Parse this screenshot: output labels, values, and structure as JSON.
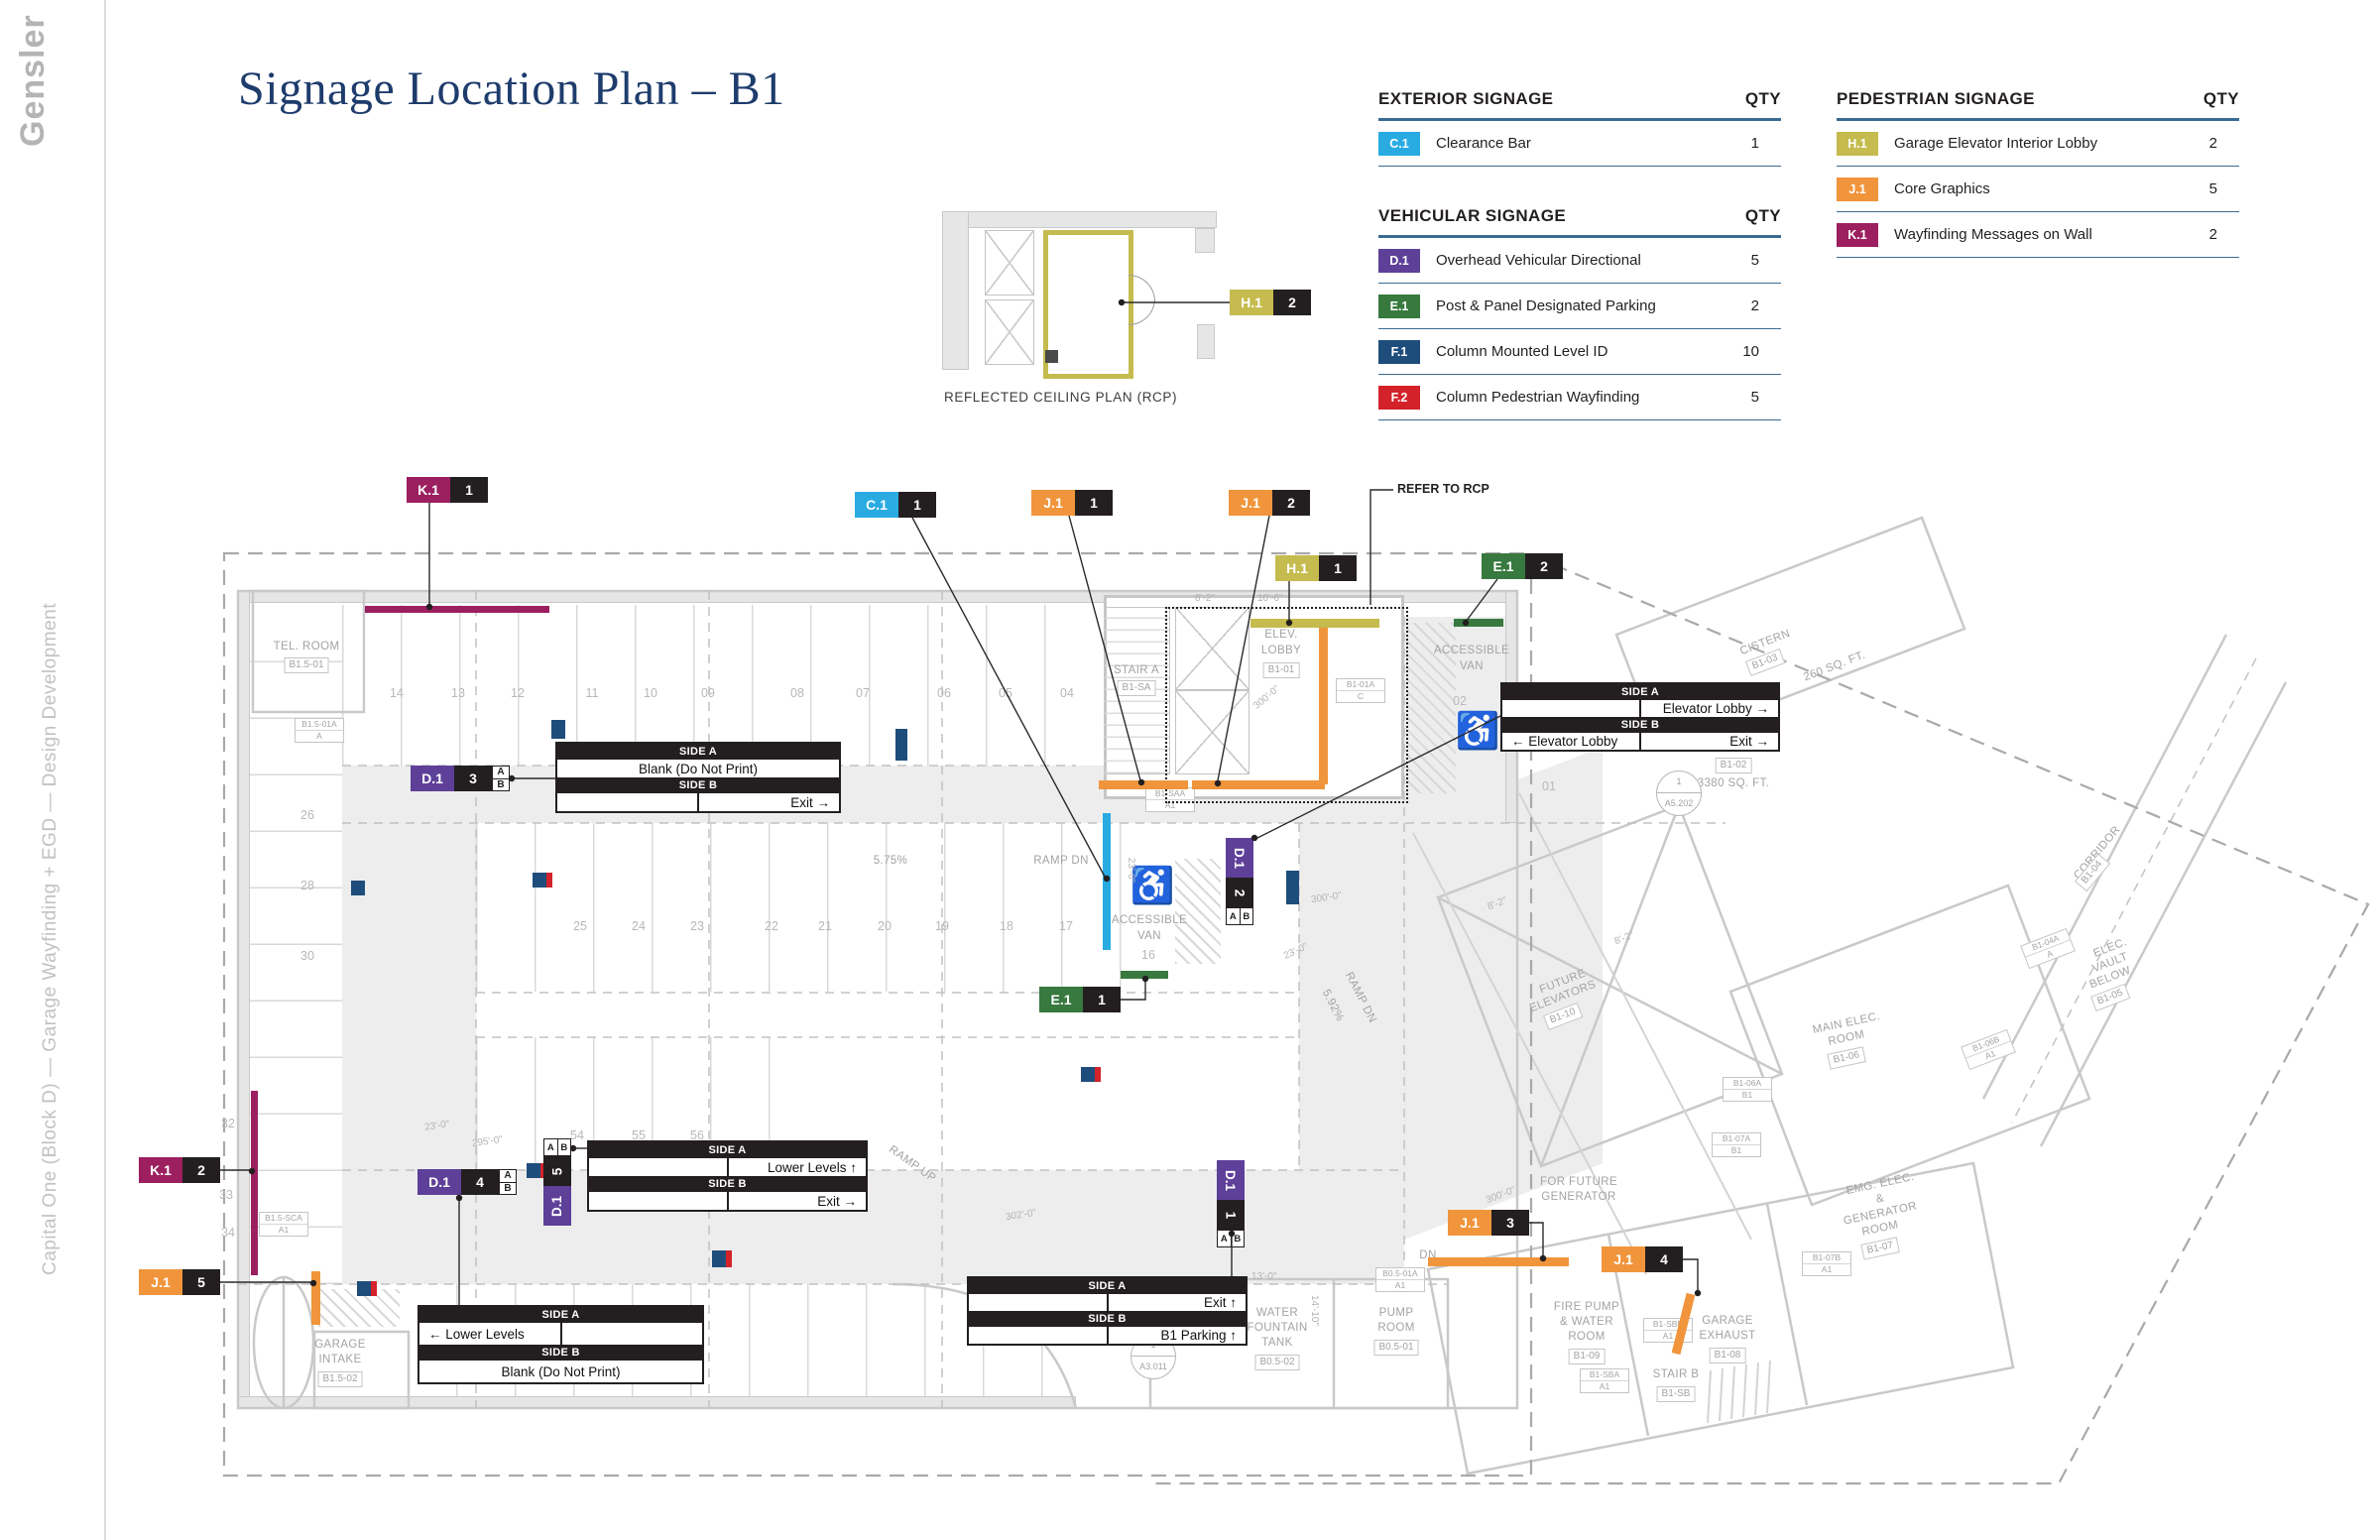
{
  "brand": {
    "logo": "Gensler",
    "project": "Capital One (Block D) — Garage Wayfinding + EGD — Design Development"
  },
  "title": "Signage Location Plan – B1",
  "legend": {
    "sections": [
      {
        "title": "EXTERIOR SIGNAGE",
        "qty_label": "QTY",
        "rows": [
          {
            "code": "C.1",
            "color": "#29abe2",
            "label": "Clearance Bar",
            "qty": "1"
          }
        ]
      },
      {
        "title": "VEHICULAR SIGNAGE",
        "qty_label": "QTY",
        "rows": [
          {
            "code": "D.1",
            "color": "#5e4099",
            "label": "Overhead Vehicular Directional",
            "qty": "5"
          },
          {
            "code": "E.1",
            "color": "#37793f",
            "label": "Post & Panel Designated Parking",
            "qty": "2"
          },
          {
            "code": "F.1",
            "color": "#1f4d7b",
            "label": "Column Mounted Level ID",
            "qty": "10"
          },
          {
            "code": "F.2",
            "color": "#d3222a",
            "label": "Column Pedestrian Wayfinding",
            "qty": "5"
          }
        ]
      },
      {
        "title": "PEDESTRIAN SIGNAGE",
        "qty_label": "QTY",
        "rows": [
          {
            "code": "H.1",
            "color": "#c5bb4e",
            "label": "Garage Elevator Interior Lobby",
            "qty": "2"
          },
          {
            "code": "J.1",
            "color": "#f0953c",
            "label": "Core Graphics",
            "qty": "5"
          },
          {
            "code": "K.1",
            "color": "#9c1f60",
            "label": "Wayfinding Messages on Wall",
            "qty": "2"
          }
        ]
      }
    ]
  },
  "rcp": {
    "caption": "REFLECTED CEILING PLAN (RCP)",
    "note": "REFER TO RCP"
  },
  "ab": {
    "a": "A",
    "b": "B"
  },
  "tags": [
    {
      "code": "K.1",
      "num": "1"
    },
    {
      "code": "C.1",
      "num": "1"
    },
    {
      "code": "J.1",
      "num": "1"
    },
    {
      "code": "J.1",
      "num": "2"
    },
    {
      "code": "H.1",
      "num": "1"
    },
    {
      "code": "E.1",
      "num": "2"
    },
    {
      "code": "H.1",
      "num": "2"
    },
    {
      "code": "D.1",
      "num": "3"
    },
    {
      "code": "D.1",
      "num": "2"
    },
    {
      "code": "E.1",
      "num": "1"
    },
    {
      "code": "D.1",
      "num": "4"
    },
    {
      "code": "D.1",
      "num": "5"
    },
    {
      "code": "D.1",
      "num": "1"
    },
    {
      "code": "K.1",
      "num": "2"
    },
    {
      "code": "J.1",
      "num": "5"
    },
    {
      "code": "J.1",
      "num": "3"
    },
    {
      "code": "J.1",
      "num": "4"
    }
  ],
  "panel_headers": {
    "side_a": "SIDE A",
    "side_b": "SIDE B"
  },
  "panels": [
    {
      "a_left": "",
      "a_right": "Elevator Lobby  →",
      "b_left": "←  Elevator Lobby",
      "b_right": "Exit  →"
    },
    {
      "a_full": "Blank (Do Not Print)",
      "b_left": "",
      "b_right": "Exit  →"
    },
    {
      "a_left": "←  Lower Levels",
      "a_right": "",
      "b_full": "Blank (Do Not Print)"
    },
    {
      "a_left": "",
      "a_right": "Lower Levels  ↑",
      "b_left": "",
      "b_right": "Exit  →"
    },
    {
      "a_left": "",
      "a_right": "Exit  ↑",
      "b_left": "",
      "b_right": "B1 Parking  ↑"
    }
  ],
  "plan": {
    "stalls_top": [
      "14",
      "13",
      "12",
      "11",
      "10",
      "09",
      "08",
      "07",
      "06",
      "05",
      "04"
    ],
    "stalls_mid": [
      "25",
      "24",
      "23",
      "22",
      "21",
      "20",
      "19",
      "18",
      "17"
    ],
    "stalls_mid2": [
      "54",
      "55",
      "56"
    ],
    "stalls_left": [
      "26",
      "28",
      "30",
      "32",
      "33",
      "34"
    ],
    "stall_15": "15",
    "stall_16": "16",
    "stall_01": "01",
    "stall_02": "02",
    "labels": {
      "tel_room": "TEL. ROOM",
      "tel_id": "B1.5-01",
      "stair_a": "STAIR A",
      "stair_a_id": "B1-SA",
      "elev": "ELEV.",
      "lobby": "LOBBY",
      "lobby_id": "B1-01",
      "accessible": "ACCESSIBLE",
      "van": "VAN",
      "wheelchair": "♿",
      "ramp_dn": "RAMP DN",
      "ramp_up": "RAMP UP",
      "slope1": "5.75%",
      "slope2": "5.92%",
      "cistern": "CISTERN",
      "cistern_id": "B1-03",
      "cistern_sf": "260 SQ. FT.",
      "vault_id": "B1-02",
      "vault_sf": "3380 SQ. FT.",
      "corridor": "CORRIDOR",
      "corridor_id": "B1-04",
      "elec": "ELEC.",
      "vault": "VAULT",
      "below": "BELOW",
      "elec_vault_id": "B1-05",
      "future": "FUTURE",
      "elevators": "ELEVATORS",
      "future_elev_id": "B1-10",
      "main_elec": "MAIN ELEC.",
      "room": "ROOM",
      "main_elec_id": "B1-06",
      "for_future": "FOR FUTURE",
      "generator": "GENERATOR",
      "emg_elec": "EMG. ELEC.",
      "amp": "&",
      "gen_room_id": "B1-07",
      "fire_pump": "FIRE PUMP",
      "and_water": "& WATER",
      "fire_pump_id": "B1-09",
      "garage": "GARAGE",
      "exhaust": "EXHAUST",
      "garage_exh_id": "B1-08",
      "stair_b": "STAIR B",
      "stair_b_id": "B1-SB",
      "water": "WATER",
      "fountain": "FOUNTAIN",
      "tank": "TANK",
      "tank_id": "B0.5-02",
      "pump": "PUMP",
      "pump_id": "B0.5-01",
      "intake": "INTAKE",
      "intake_id": "B1.5-02",
      "dn": "DN",
      "dim_10_6": "10'-6\"",
      "dim_8_2": "8'-2\"",
      "dim_23_0": "23'-0\"",
      "dim_295_0": "295'-0\"",
      "dim_300_0": "300'-0\"",
      "dim_302_0": "302'-0\"",
      "dim_13_0": "13'-0\"",
      "dim_14_10": "14'-10\"",
      "detail1_top": "1",
      "detail1_bot": "A5.202",
      "detail2_top": "1",
      "detail2_bot": "A3.011"
    },
    "hexes": [
      {
        "a": "B1.5-01A",
        "b": "A"
      },
      {
        "a": "B1-01A",
        "b": "C"
      },
      {
        "a": "B1-SAA",
        "b": "A1"
      },
      {
        "a": "B1.5-SCA",
        "b": "A1"
      },
      {
        "a": "B0.5-01A",
        "b": "A1"
      },
      {
        "a": "B1-06A",
        "b": "B1"
      },
      {
        "a": "B1-07A",
        "b": "B1"
      },
      {
        "a": "B1-07B",
        "b": "A1"
      },
      {
        "a": "B1-SBB",
        "b": "A1"
      },
      {
        "a": "B1-SBA",
        "b": "A1"
      },
      {
        "a": "B1-04A",
        "b": "A"
      },
      {
        "a": "B1-06B",
        "b": "A1"
      }
    ]
  }
}
